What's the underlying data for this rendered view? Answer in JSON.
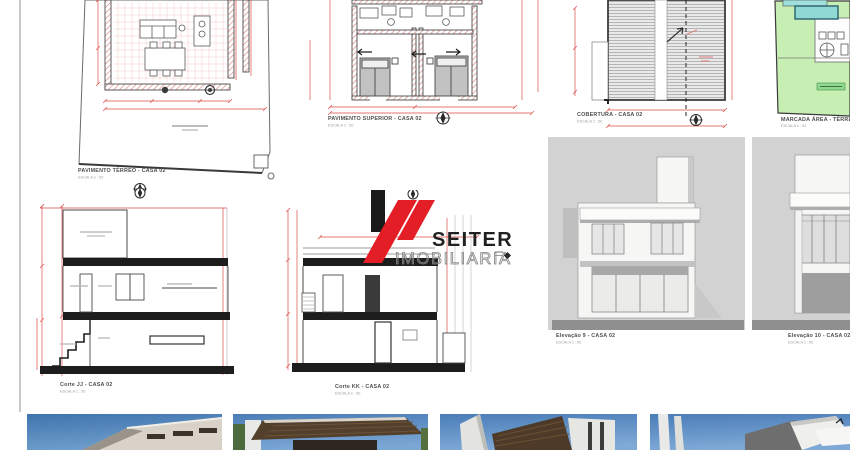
{
  "watermark": {
    "brand": "SEITER",
    "subtitle": "IMOBILIARIA",
    "accent_red": "#e31e26",
    "bar_black": "#1a1a1a"
  },
  "panels": {
    "terreo": {
      "label": "PAVIMENTO TÉRREO - CASA 02",
      "scale": "ESCALA  1 : 50"
    },
    "superior": {
      "label": "PAVIMENTO SUPERIOR - CASA 02",
      "scale": "ESCALA  1 : 50"
    },
    "cobertura": {
      "label": "COBERTURA - CASA 02",
      "scale": "ESCALA  1 : 50"
    },
    "implantacao": {
      "label": "MARCADA ÁREA - TÉRREO",
      "scale": "ESCALA  1 : 50"
    },
    "corte_jj": {
      "label": "Corte JJ - CASA 02",
      "scale": "ESCALA  1 : 50"
    },
    "corte_kk": {
      "label": "Corte KK - CASA 02",
      "scale": "ESCALA  1 : 50"
    },
    "elevacao_9": {
      "label": "Elevação 9 - CASA 02",
      "scale": "ESCALA  1 : 50"
    },
    "elevacao_10": {
      "label": "Elevação 10 - CASA 02",
      "scale": "ESCALA  1 : 50"
    }
  },
  "colors": {
    "dimension_red": "#d94a45",
    "line_dark": "#4a4a4a",
    "lawn_green": "#c7efb4",
    "pool_cyan": "#8fd8d4",
    "elevation_bg": "#d2d2d2",
    "ground_gray": "#8f8f8f",
    "sky_blue": "#4b7db8",
    "roof_wood": "#53402c"
  },
  "thumbnails": [
    {
      "name": "render-photo-1",
      "description": "3D render: white modern house corner against blue sky"
    },
    {
      "name": "render-photo-2",
      "description": "3D render: dark wood roof soffit against blue sky"
    },
    {
      "name": "render-photo-3",
      "description": "3D render: wood canopy and white volumes against blue sky"
    },
    {
      "name": "render-photo-4",
      "description": "3D render: gray and white angular house against blue sky"
    }
  ]
}
